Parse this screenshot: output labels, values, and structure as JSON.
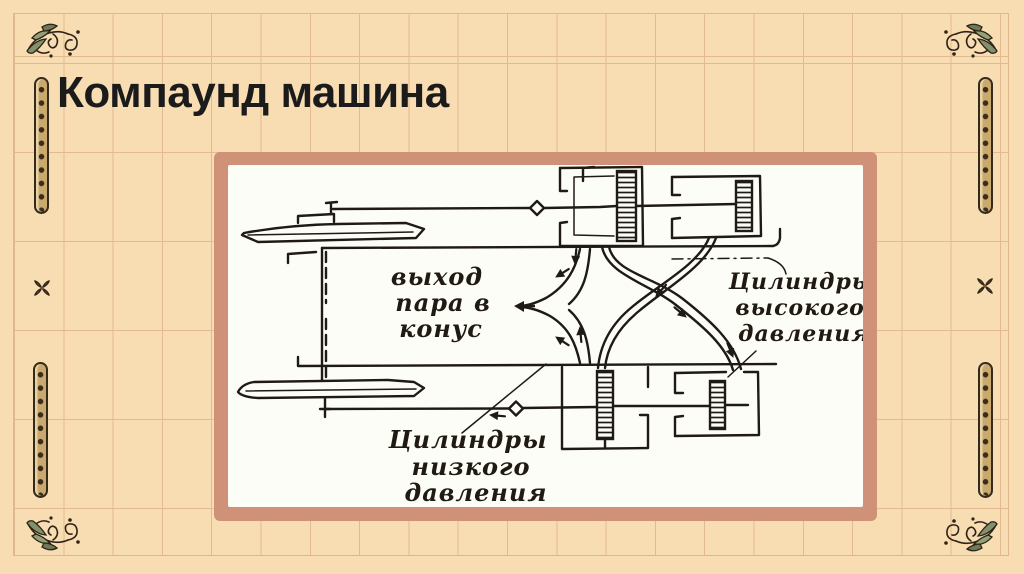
{
  "slide": {
    "title": "Компаунд машина",
    "colors": {
      "background": "#f8dcb2",
      "grid_line": "#e3ba8f",
      "frame": "#cf9278",
      "paper": "#fdfdf8",
      "ink": "#1f1a14",
      "ornament_leaf": "#83906a",
      "strip_fill": "#c9a96d",
      "title_text": "#1b1b1b"
    }
  },
  "figure": {
    "description": "Hand-drawn schematic of a compound steam engine with crossed steam pipes",
    "labels": {
      "exhaust": {
        "line1": "выход",
        "line2": "пара в",
        "line3": "конус"
      },
      "high_pressure": {
        "line1": "Цилиндры",
        "line2": "высокого",
        "line3": "давления"
      },
      "low_pressure": {
        "line1": "Цилиндры",
        "line2": "низкого",
        "line3": "давления"
      }
    }
  }
}
